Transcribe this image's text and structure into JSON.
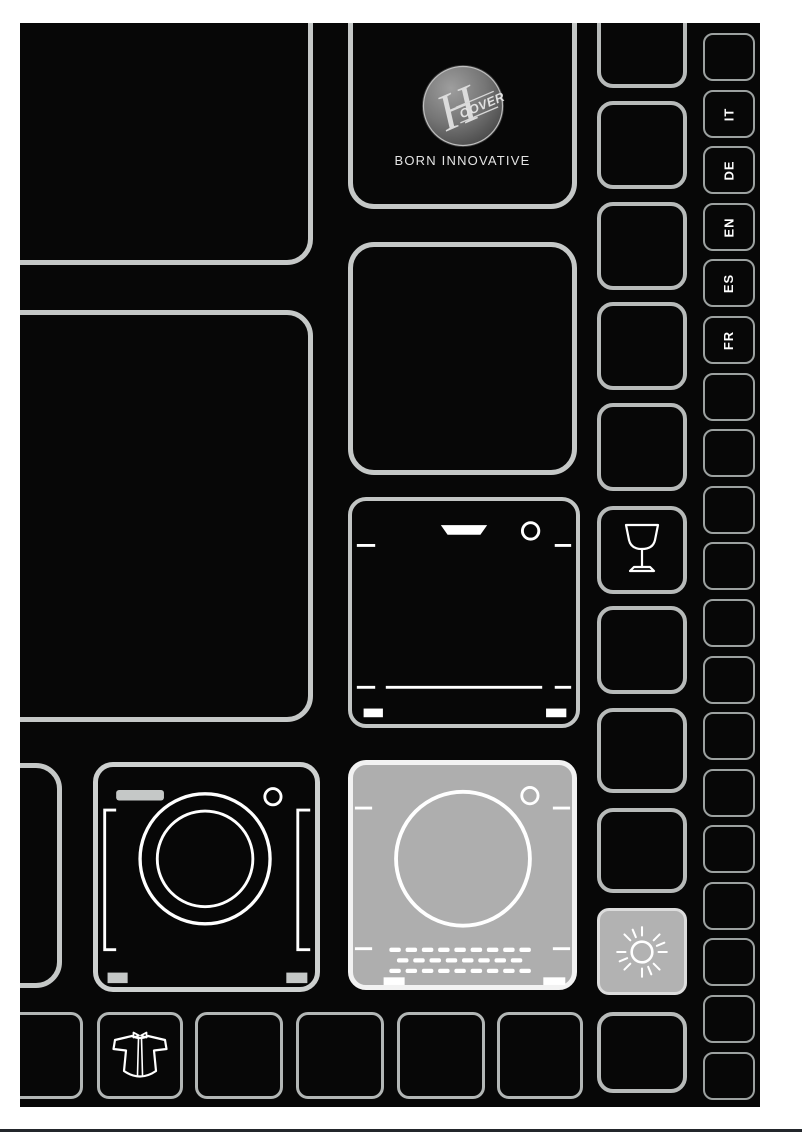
{
  "brand": {
    "logo_h": "H",
    "logo_band": "OOVER",
    "tagline": "BORN INNOVATIVE"
  },
  "languages": [
    "IT",
    "DE",
    "EN",
    "ES",
    "FR"
  ],
  "icons": {
    "logo": "hoover-logo",
    "glass": "wine-glass-icon",
    "sun": "sun-icon",
    "washer": "washing-machine-icon",
    "dryer": "tumble-dryer-icon",
    "dishwasher": "dishwasher-icon",
    "shirt": "shirt-icon"
  },
  "colors": {
    "page_background": "#ffffff",
    "panel_background": "#070707",
    "cell_border_bright": "#c5c8c7",
    "cell_border_dim": "#9ca1a0",
    "highlight_fill": "#aeaeae",
    "icon_stroke": "#ffffff",
    "bottom_rule": "#23262b"
  }
}
